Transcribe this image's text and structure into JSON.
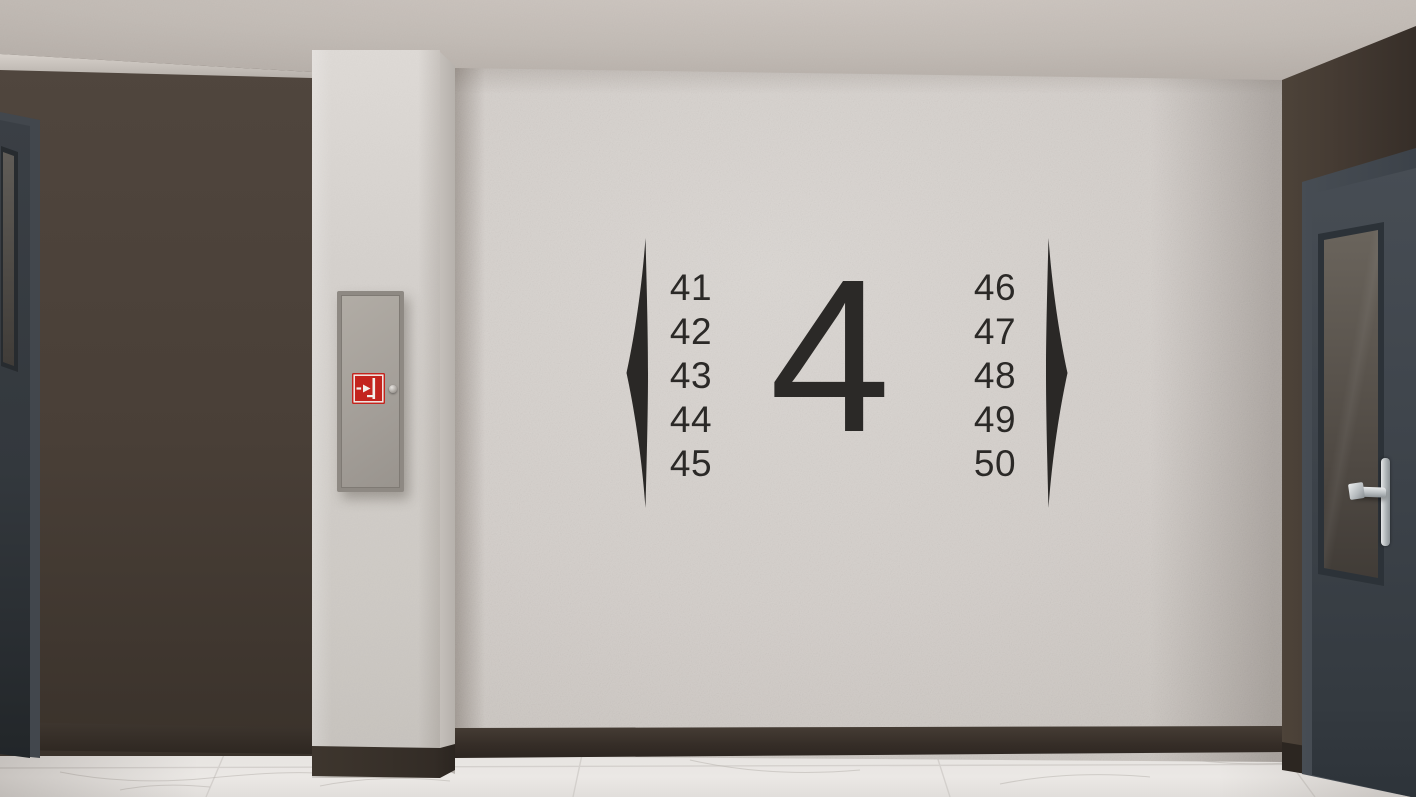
{
  "scene": {
    "description": "3D render of a residential corridor / elevator lobby with floor directory signage on a textured wall",
    "floor_sign": {
      "floor_number": "4",
      "left_units": [
        "41",
        "42",
        "43",
        "44",
        "45"
      ],
      "right_units": [
        "46",
        "47",
        "48",
        "49",
        "50"
      ],
      "text_color": "#2b2927"
    },
    "icons": {
      "fire_cabinet_sign": "fire-hose-cabinet-sign",
      "left_decoration": "blade-bracket-left",
      "right_decoration": "blade-bracket-right"
    },
    "colors": {
      "ceiling": "#c3bcb6",
      "main_wall": "#d6d1cd",
      "side_walls": "#473d35",
      "baseboard": "#342d27",
      "column": "#d6d2ce",
      "floor_marble": "#e9e6e3",
      "doors": "#3f454c",
      "fire_cabinet": "#a39e98",
      "fire_sign_red": "#c3241e",
      "handle_chrome": "#c9cccd"
    }
  }
}
